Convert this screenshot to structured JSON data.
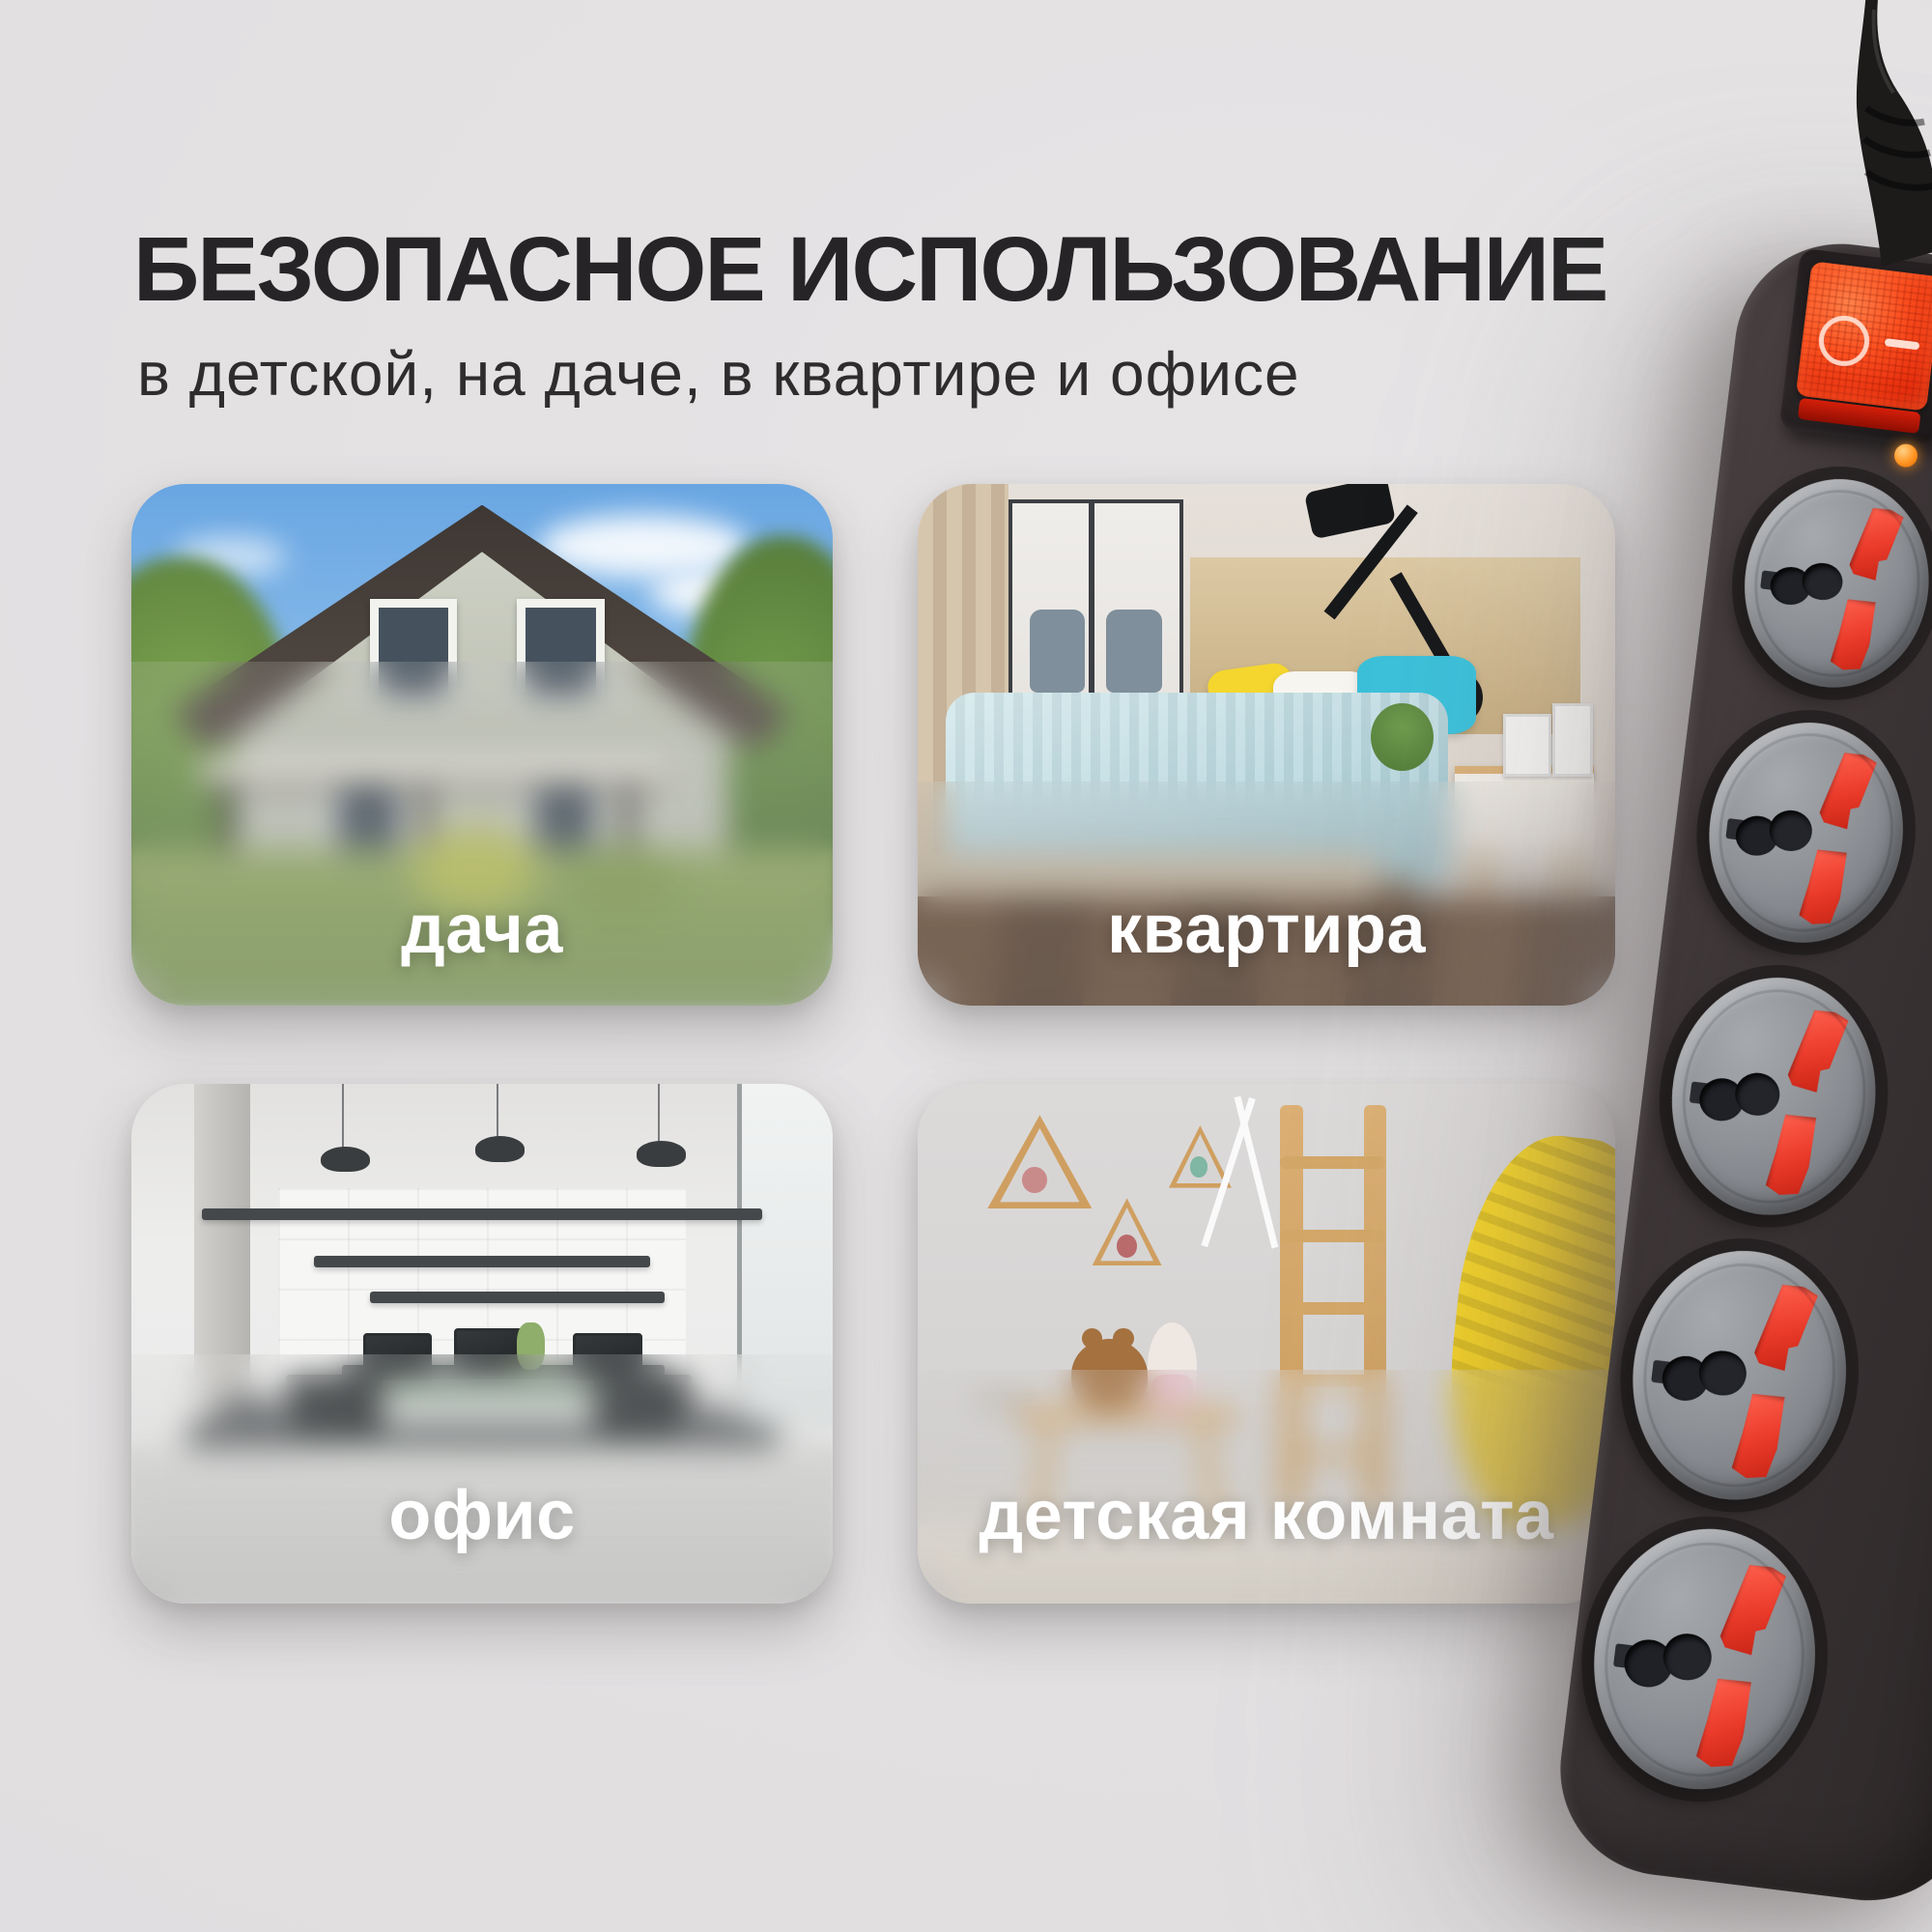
{
  "page": {
    "background_color": "#e2e0e1"
  },
  "header": {
    "title": "БЕЗОПАСНОЕ ИСПОЛЬЗОВАНИЕ",
    "subtitle": "в детской, на даче, в квартире и офисе"
  },
  "cards": [
    {
      "label": "дача"
    },
    {
      "label": "квартира"
    },
    {
      "label": "офис"
    },
    {
      "label": "детская комната"
    }
  ],
  "product": {
    "sockets_visible": 5,
    "switch_symbols": {
      "off": "O",
      "on": "—"
    },
    "colors": {
      "body": "#3a3334",
      "socket_face": "#8f9297",
      "socket_slots": "#ea3a2a",
      "switch_glow": "#fb4f1f",
      "indicator": "#ff9422"
    }
  }
}
